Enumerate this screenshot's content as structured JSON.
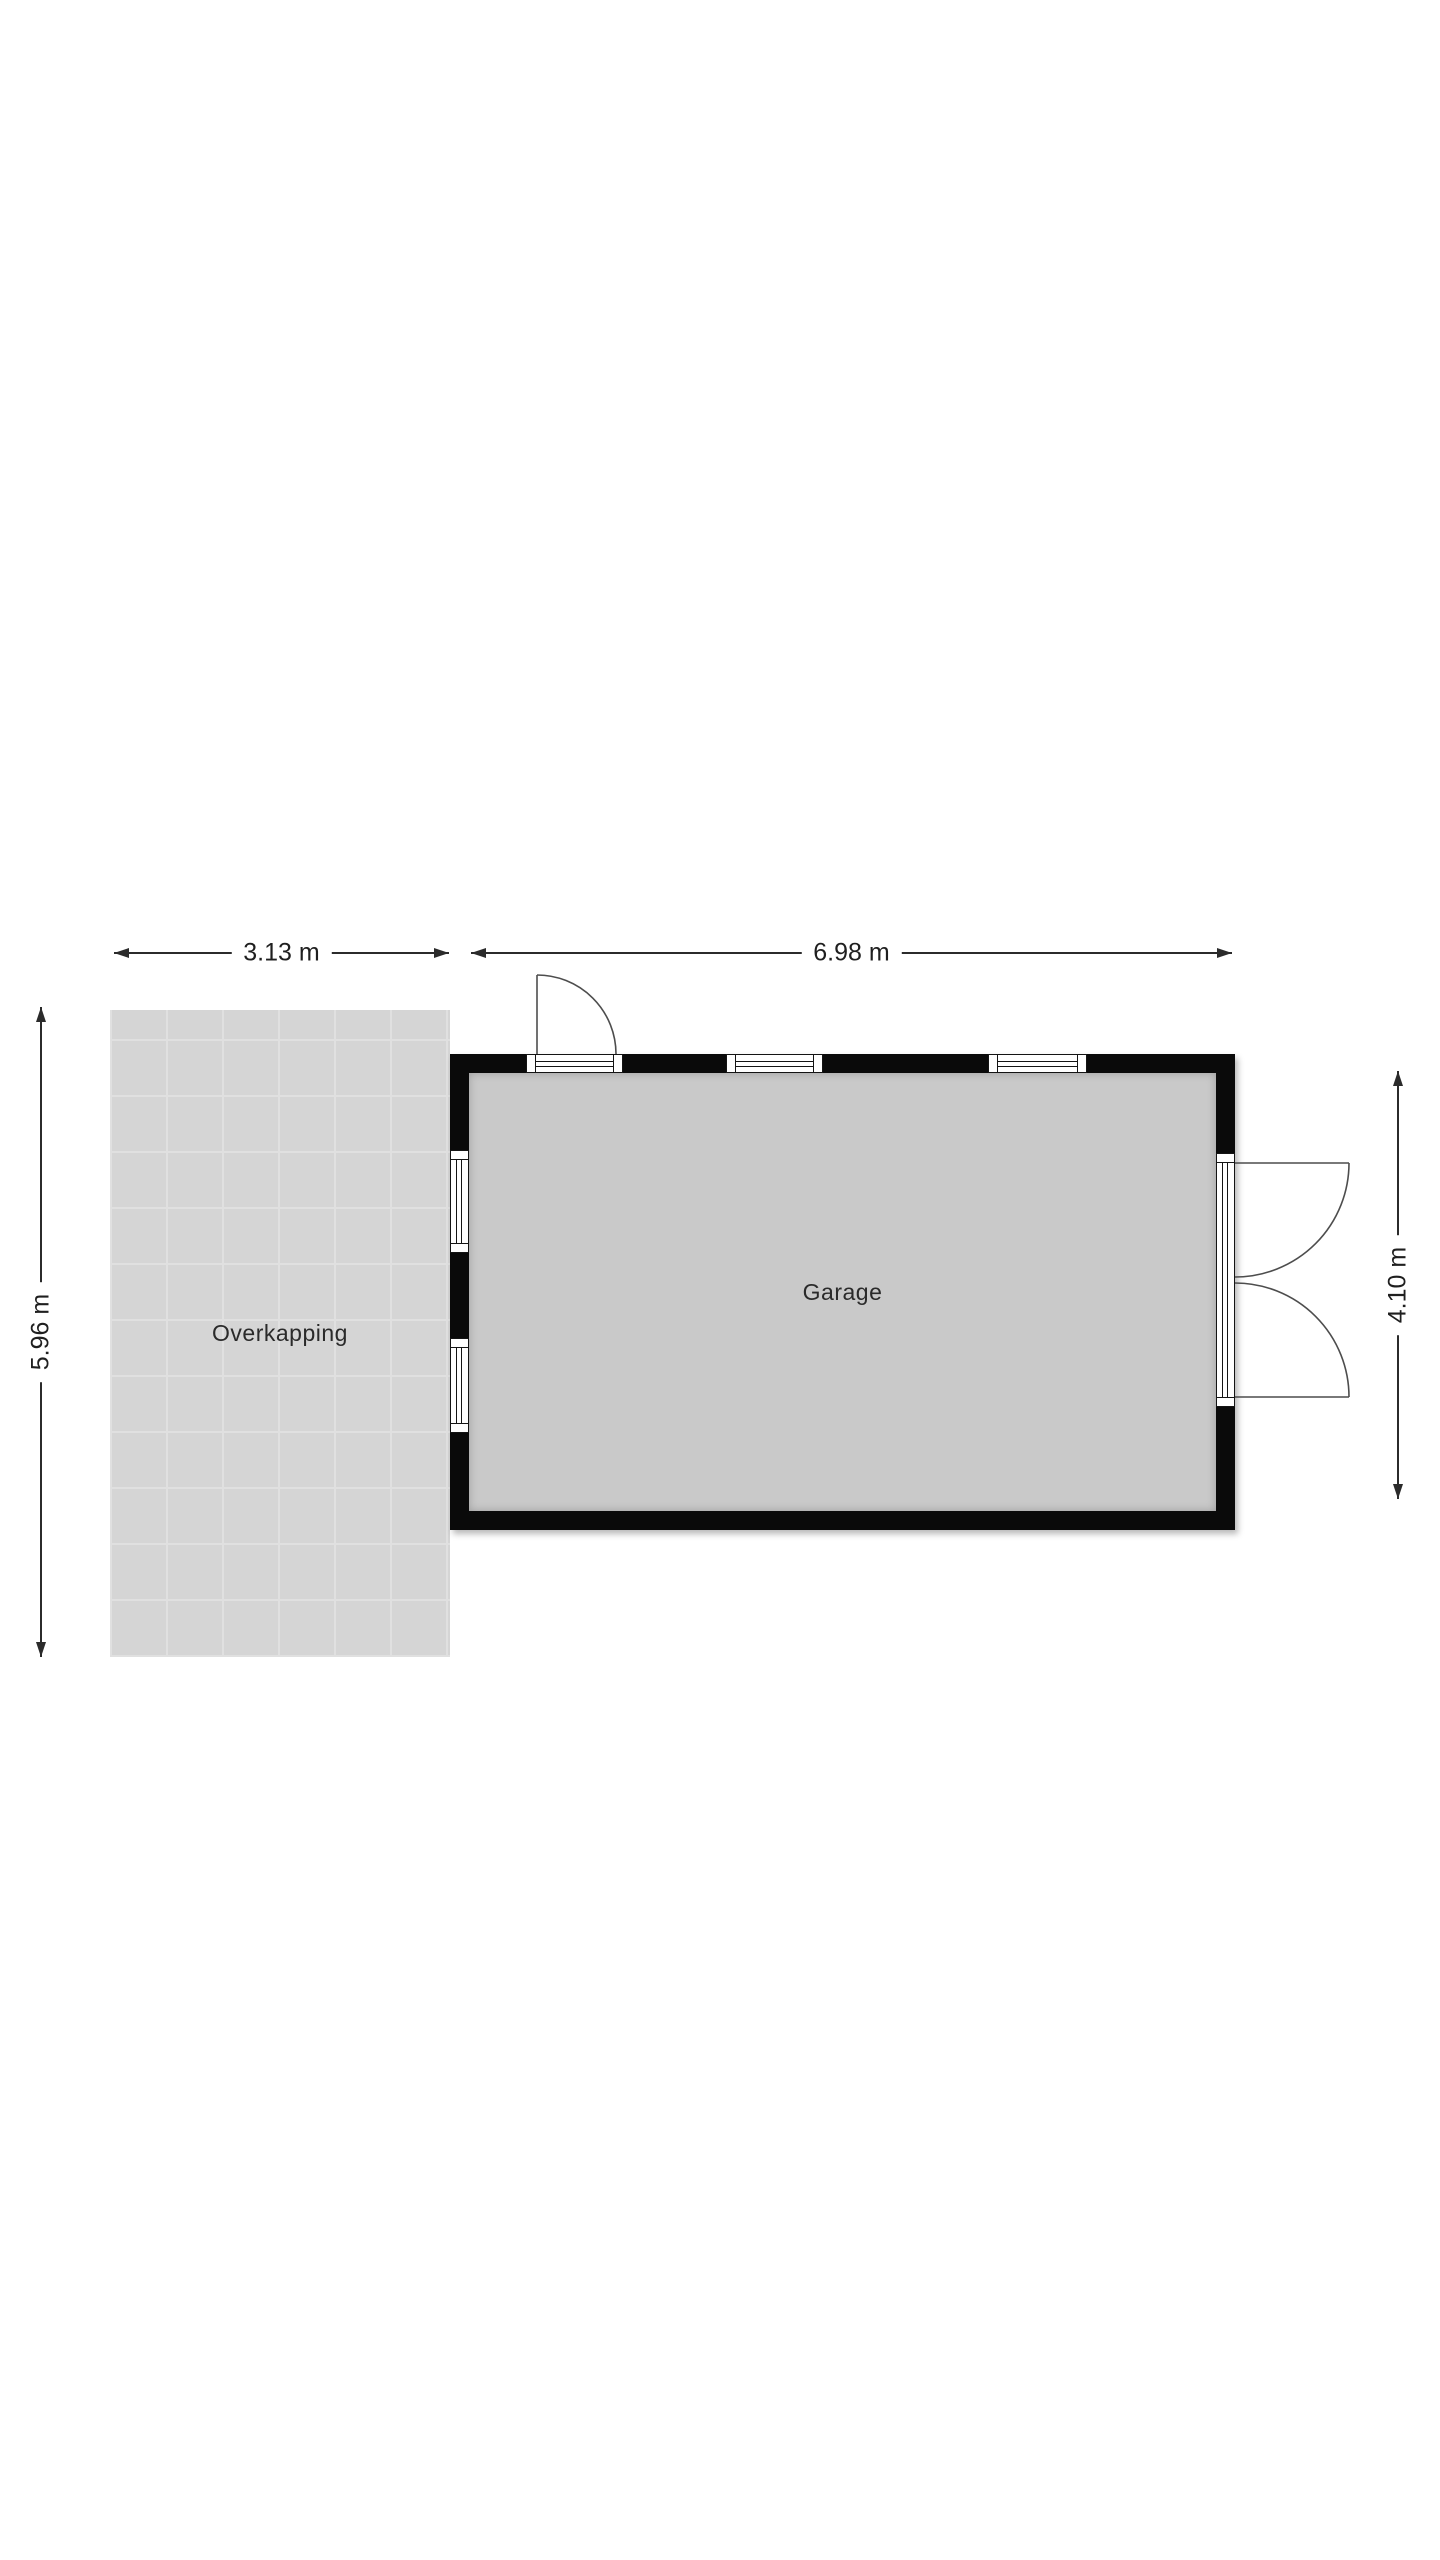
{
  "plan": {
    "type": "floor-plan",
    "rooms": [
      {
        "name": "Garage",
        "width_label": "6.98 m",
        "depth_label": "4.10 m"
      },
      {
        "name": "Overkapping",
        "width_label": "3.13 m",
        "depth_label": "5.96 m"
      }
    ],
    "dimensions": {
      "top_left": "3.13 m",
      "top_right": "6.98 m",
      "left": "5.96 m",
      "right": "4.10 m"
    },
    "features": {
      "doors": [
        "single-door-top-wall",
        "double-door-right-wall"
      ],
      "windows": [
        "window-top-1",
        "window-top-2",
        "window-left-1",
        "window-left-2"
      ]
    },
    "colors": {
      "background": "#ffffff",
      "wall": "#0a0a0a",
      "garage_floor": "#c9c9c9",
      "overkapping_floor": "#d5d5d5",
      "overkapping_grid": "#e0e0e0",
      "dimension_line": "#2b2b2b",
      "door_swing": "#4d4d4d"
    }
  }
}
